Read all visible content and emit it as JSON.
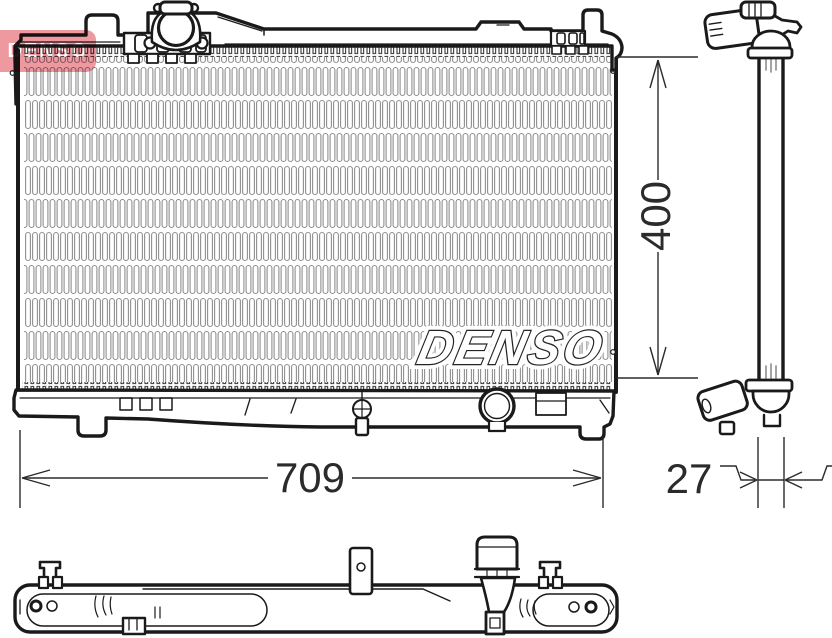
{
  "watermarks": {
    "brand_logo": "DENSO",
    "core_text": "DENSO"
  },
  "dimensions": {
    "height_mm": "400",
    "width_mm": "709",
    "depth_mm": "27"
  },
  "colors": {
    "line": "#1a1a1a",
    "fin_gray": "#8f8f8f",
    "dimension_text": "#2b2b2b",
    "brand_red": "#ee98a0"
  }
}
